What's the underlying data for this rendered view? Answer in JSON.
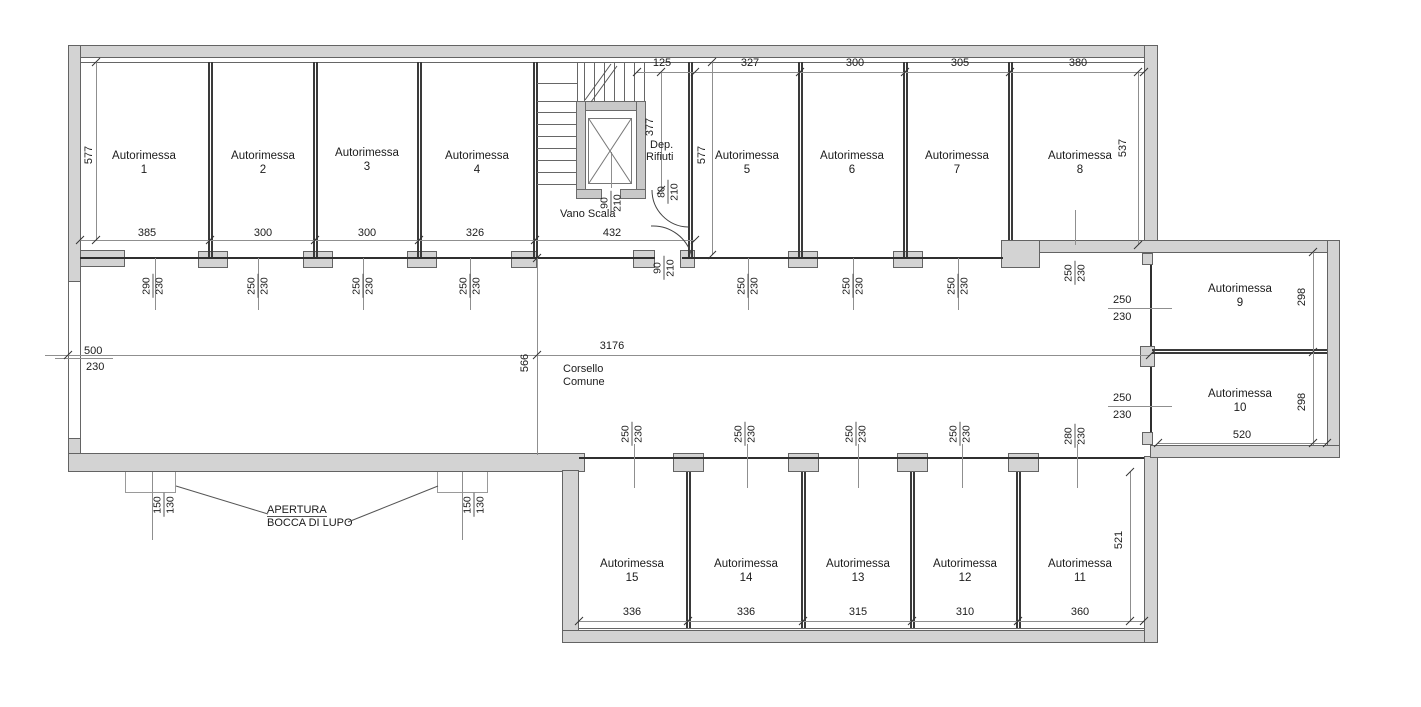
{
  "garages": [
    {
      "name": "Autorimessa",
      "number": "1"
    },
    {
      "name": "Autorimessa",
      "number": "2"
    },
    {
      "name": "Autorimessa",
      "number": "3"
    },
    {
      "name": "Autorimessa",
      "number": "4"
    },
    {
      "name": "Autorimessa",
      "number": "5"
    },
    {
      "name": "Autorimessa",
      "number": "6"
    },
    {
      "name": "Autorimessa",
      "number": "7"
    },
    {
      "name": "Autorimessa",
      "number": "8"
    },
    {
      "name": "Autorimessa",
      "number": "9"
    },
    {
      "name": "Autorimessa",
      "number": "10"
    },
    {
      "name": "Autorimessa",
      "number": "11"
    },
    {
      "name": "Autorimessa",
      "number": "12"
    },
    {
      "name": "Autorimessa",
      "number": "13"
    },
    {
      "name": "Autorimessa",
      "number": "14"
    },
    {
      "name": "Autorimessa",
      "number": "15"
    }
  ],
  "labels": {
    "vano_scala": "Vano Scala",
    "dep_l1": "Dep.",
    "dep_l2": "Rifiuti",
    "corsello_l1": "Corsello",
    "corsello_l2": "Comune",
    "apertura_l1": "APERTURA",
    "apertura_l2": "BOCCA DI LUPO"
  },
  "dims": {
    "top_widths": [
      "385",
      "300",
      "300",
      "326"
    ],
    "stair_width": "432",
    "stair_top": "125",
    "stair_depth": "377",
    "top_widths_right": [
      "327",
      "300",
      "305",
      "380"
    ],
    "bottom_widths": [
      "336",
      "336",
      "315",
      "310",
      "360"
    ],
    "corridor_length": "3176",
    "corridor_width": "566",
    "height_left": "577",
    "height_mid": "577",
    "height_g8": "537",
    "g9_height": "298",
    "g10_height": "298",
    "g10_width": "520",
    "g11_height": "521"
  },
  "door_dims": {
    "g1": {
      "num": "290",
      "den": "230"
    },
    "g2": {
      "num": "250",
      "den": "230"
    },
    "g3": {
      "num": "250",
      "den": "230"
    },
    "g4": {
      "num": "250",
      "den": "230"
    },
    "g5": {
      "num": "250",
      "den": "230"
    },
    "g6": {
      "num": "250",
      "den": "230"
    },
    "g7": {
      "num": "250",
      "den": "230"
    },
    "g8": {
      "num": "250",
      "den": "230"
    },
    "g9": {
      "num": "250",
      "den": "230"
    },
    "g10": {
      "num": "250",
      "den": "230"
    },
    "g11": {
      "num": "280",
      "den": "230"
    },
    "g12": {
      "num": "250",
      "den": "230"
    },
    "g13": {
      "num": "250",
      "den": "230"
    },
    "g14": {
      "num": "250",
      "den": "230"
    },
    "g15": {
      "num": "250",
      "den": "230"
    },
    "elevator": {
      "num": "90",
      "den": "210"
    },
    "rifiuti": {
      "num": "80",
      "den": "210"
    },
    "scala": {
      "num": "90",
      "den": "210"
    },
    "entrance": {
      "num": "500",
      "den": "230"
    },
    "bocca1": {
      "num": "150",
      "den": "130"
    },
    "bocca2": {
      "num": "150",
      "den": "130"
    }
  }
}
